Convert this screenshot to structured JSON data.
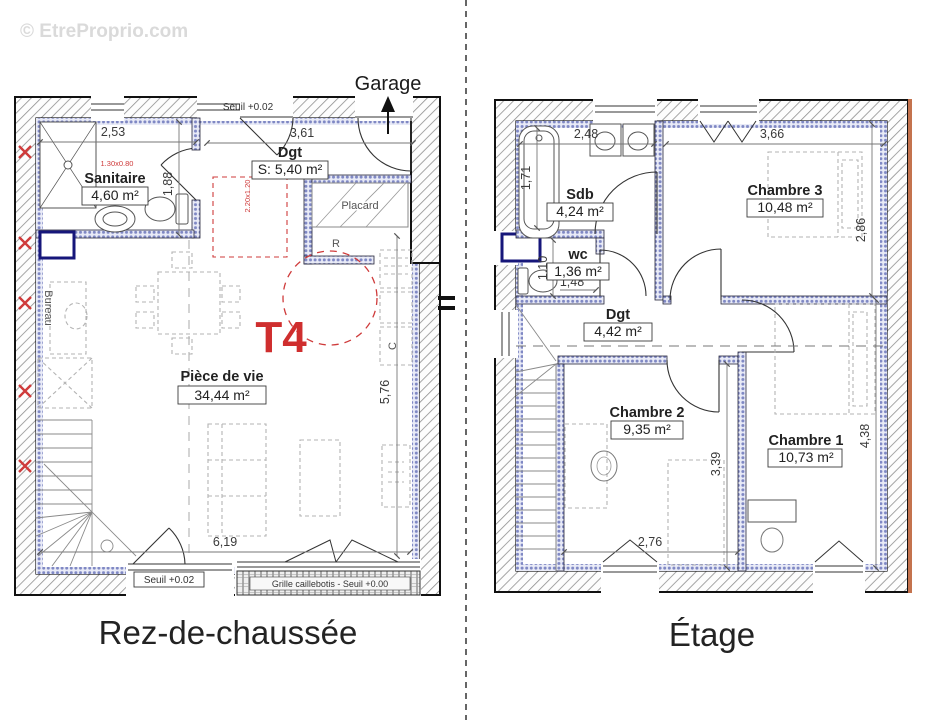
{
  "watermark": "© EtreProprio.com",
  "colors": {
    "accent_red": "#cf2e2e",
    "insulation_blue": "#7f88c4",
    "window_navy": "#16167a",
    "exterior_orange": "#c4734e"
  },
  "ground_floor": {
    "title": "Rez-de-chaussée",
    "garage_label": "Garage",
    "type_label": "T4",
    "rooms": {
      "sanitaire": {
        "name": "Sanitaire",
        "area": "4,60 m²"
      },
      "degagement": {
        "name": "Dgt",
        "area": "S: 5,40 m²"
      },
      "piece_de_vie": {
        "name": "Pièce de vie",
        "area": "34,44 m²"
      },
      "placard": {
        "name": "Placard"
      },
      "reserve": {
        "name": "R"
      },
      "cuisine": {
        "name": "C"
      },
      "bureau": {
        "name": "Bureau"
      }
    },
    "dimensions": {
      "sanitaire_width": "2,53",
      "entree_width": "3,61",
      "sanitaire_depth": "1,88",
      "sejour_depth": "5,76",
      "sejour_width": "6,19",
      "douche": "1.30x0.80",
      "baie": "2.20x1.20"
    },
    "annotations": {
      "seuil_entree": "Seuil +0.02",
      "seuil_baie": "Seuil +0.02",
      "grille": "Grille caillebotis - Seuil +0.00"
    }
  },
  "upper_floor": {
    "title": "Étage",
    "rooms": {
      "sdb": {
        "name": "Sdb",
        "area": "4,24 m²"
      },
      "wc": {
        "name": "wc",
        "area": "1,36 m²"
      },
      "chambre3": {
        "name": "Chambre 3",
        "area": "10,48 m²"
      },
      "degagement": {
        "name": "Dgt",
        "area": "4,42 m²"
      },
      "chambre2": {
        "name": "Chambre 2",
        "area": "9,35 m²"
      },
      "chambre1": {
        "name": "Chambre 1",
        "area": "10,73 m²"
      }
    },
    "dimensions": {
      "sdb_width": "2,48",
      "chambre3_width": "3,66",
      "baignoire": "1,71",
      "chambre3_depth": "2,86",
      "wc_depth": "1,10",
      "wc_width": "1,48",
      "chambre2_depth": "3,39",
      "chambre1_depth": "4,38",
      "chambre2_width": "2,76"
    }
  }
}
